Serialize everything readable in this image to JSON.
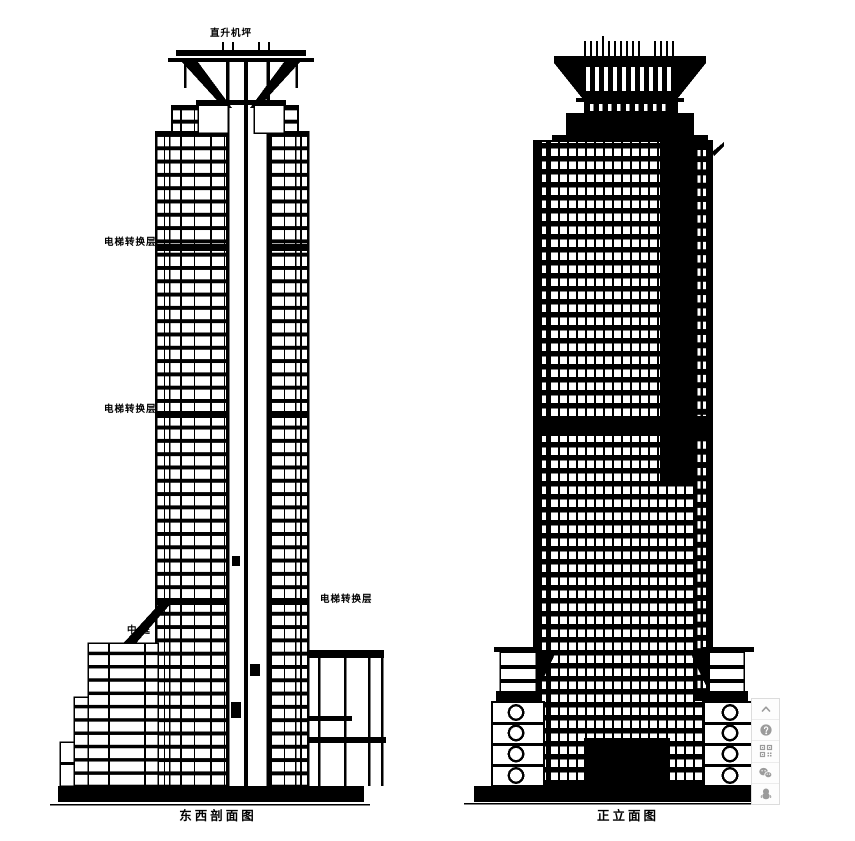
{
  "window": {
    "width": 855,
    "height": 841,
    "background": "#ffffff"
  },
  "colors": {
    "ink": "#000000",
    "paper": "#ffffff",
    "toolbar_border": "#dcdcdc",
    "toolbar_bg": "#fdfdfd",
    "toolbar_icon": "#9b9b9b"
  },
  "left_drawing": {
    "caption": "东西剖面图",
    "labels": {
      "helipad": "直升机坪",
      "elevator_transfer_upper": "电梯转换层",
      "elevator_transfer_middle": "电梯转换层",
      "elevator_transfer_lower": "电梯转换层",
      "atrium": "中庭"
    }
  },
  "right_drawing": {
    "caption": "正立面图"
  },
  "toolbar": {
    "items": [
      {
        "name": "back-to-top",
        "icon": "chevron-up-icon"
      },
      {
        "name": "help",
        "icon": "question-circle-icon"
      },
      {
        "name": "qr-code",
        "icon": "qr-code-icon"
      },
      {
        "name": "wechat",
        "icon": "wechat-icon"
      },
      {
        "name": "qq",
        "icon": "qq-penguin-icon"
      }
    ]
  }
}
